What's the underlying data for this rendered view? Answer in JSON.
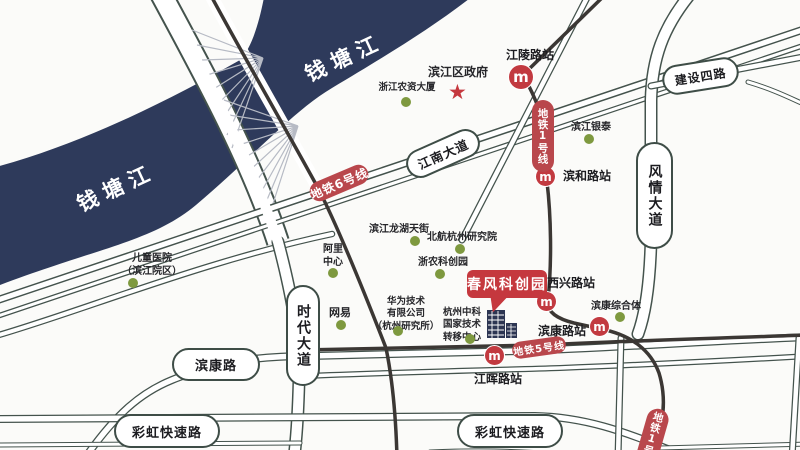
{
  "colors": {
    "red": "#bc4348",
    "navy": "#2e3a5b",
    "green_dot": "#7e993f",
    "road_line": "#44534d",
    "metro_line": "#3b3734"
  },
  "icons": {
    "star": "★",
    "metro": "m"
  },
  "river": {
    "label_left": "钱塘江",
    "label_right": "钱塘江"
  },
  "metro": {
    "line6_badge": "地铁6号线",
    "line1_badge_top": "地铁1号线",
    "line5_badge": "地铁5号线",
    "line1_badge_bottom": "地铁1号线",
    "stations": {
      "jiangling": "江陵路站",
      "binhe": "滨和路站",
      "xixing": "西兴路站",
      "binkang": "滨康路站",
      "jianghui": "江晖路站"
    }
  },
  "roads": {
    "jiangnan": "江南大道",
    "jianshe4": "建设四路",
    "fengqing": "风情大道",
    "shidai": "时代大道",
    "binkang": "滨康路",
    "caihong_left": "彩虹快速路",
    "caihong_right": "彩虹快速路"
  },
  "pois": {
    "gov": "滨江区政府",
    "nongzi": "浙江农资大厦",
    "yintai": "滨江银泰",
    "children_hospital": "儿童医院\n（滨江院区）",
    "ali": "阿里\n中心",
    "netease": "网易",
    "longhu": "滨江龙湖天街",
    "beihang": "北航杭州研究院",
    "zhenong": "浙农科创园",
    "huawei": "华为技术\n有限公司\n（杭州研究所）",
    "zhongke": "杭州中科\n国家技术\n转移中心",
    "binkang_complex": "滨康综合体"
  },
  "highlight": {
    "name": "春风科创园"
  }
}
